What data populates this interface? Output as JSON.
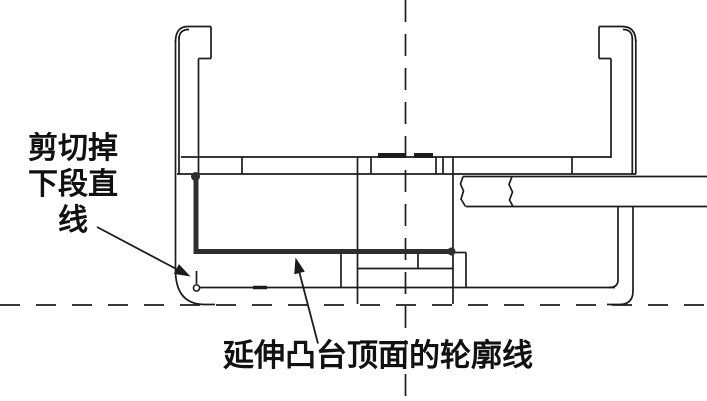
{
  "page": {
    "background": "#ffffff"
  },
  "labels": {
    "left": {
      "lines": [
        "剪切掉",
        "下段直",
        "线"
      ]
    },
    "bottom": {
      "text": "延伸凸台顶面的轮廓线"
    }
  },
  "drawing": {
    "colors": {
      "line": "#1c1c1c",
      "highlight": "#2e2e2e",
      "text": "#111111",
      "background": "#ffffff"
    },
    "stroke": {
      "thin": 1.7,
      "thick": 5,
      "arrow": 1.8
    },
    "segments": [
      [
        175.5,
        40,
        175.5,
        271
      ],
      [
        179,
        37,
        179,
        174
      ],
      [
        188,
        26.5,
        211,
        26.5
      ],
      [
        211,
        26.5,
        211,
        58.5
      ],
      [
        198.5,
        58.5,
        211,
        58.5
      ],
      [
        198.5,
        58.5,
        198.5,
        175
      ],
      [
        599,
        26.5,
        622,
        26.5
      ],
      [
        635.8,
        40,
        635.8,
        174
      ],
      [
        632.3,
        37,
        632.3,
        174
      ],
      [
        599,
        26.5,
        599,
        58.5
      ],
      [
        599,
        58.5,
        611,
        58.5
      ],
      [
        611,
        58.5,
        611,
        158
      ],
      [
        181,
        157,
        611,
        157
      ],
      [
        177,
        174,
        636,
        174
      ],
      [
        242,
        157,
        242,
        174
      ],
      [
        371,
        157,
        371,
        174
      ],
      [
        436,
        157,
        436,
        174
      ],
      [
        443,
        157,
        443,
        174
      ],
      [
        572,
        157,
        572,
        174
      ],
      [
        357.5,
        157,
        357.5,
        304
      ],
      [
        453,
        157,
        453,
        304
      ],
      [
        341,
        253,
        341,
        288
      ],
      [
        357.5,
        268.5,
        453,
        268.5
      ],
      [
        418,
        253,
        418,
        268.5
      ],
      [
        453,
        252.5,
        466,
        252.5
      ],
      [
        466,
        252.5,
        466,
        288
      ],
      [
        197,
        287.5,
        615,
        287.5
      ],
      [
        463,
        176.5,
        707,
        176.5
      ],
      [
        466,
        206.5,
        707,
        206.5
      ],
      [
        196.5,
        271,
        196.5,
        284
      ]
    ],
    "paths": [
      "M175.5,42 Q175.5,26.5 188,26.5",
      "M179,39 Q179,29.5 189,29.5",
      "M622,26.5 Q635.8,26.5 635.8,42",
      "M623,29.5 Q632.3,29.5 632.3,39",
      "M463,176.5 L460.5,184 L463.5,191 L461,199 L465.5,206.5",
      "M512,176.5 L509,184.5 L512.5,192 L509.5,200 L513,206.5",
      "M618,207 L618,280 Q618,287.5 609,287.5",
      "M633,207 L633,291 Q633,304.5 619,304.5 L607,304.5",
      "M175.5,270 Q175.5,304.5 205,304.5 L215,304.5"
    ],
    "accents": [
      {
        "seg": [
          378,
          155.5,
          406,
          155.5
        ],
        "w": 5
      },
      {
        "seg": [
          414,
          155.5,
          433,
          155.5
        ],
        "w": 5
      },
      {
        "seg": [
          253,
          287.5,
          267,
          287.5
        ],
        "w": 3.5
      }
    ],
    "centerlines": [
      {
        "x1": 405.5,
        "y1": 0,
        "x2": 405.5,
        "y2": 401,
        "dash": "22 12"
      },
      {
        "x1": 0,
        "y1": 305,
        "x2": 707,
        "y2": 305,
        "dash": "20 16"
      }
    ],
    "highlight": {
      "path": "M196,177 L196,251.5 L451.5,251.5",
      "width": 5,
      "dots": [
        [
          195.5,
          176.5,
          4.5
        ],
        [
          451.5,
          251.5,
          4
        ]
      ]
    },
    "marker_circle": {
      "cx": 196.5,
      "cy": 288,
      "r": 3.1
    },
    "arrows": [
      {
        "tail": [
          97,
          227
        ],
        "tip": [
          190.5,
          276.5
        ]
      },
      {
        "tail": [
          318,
          343.5
        ],
        "tip": [
          295.5,
          257.5
        ]
      }
    ],
    "arrow_head": {
      "length": 16,
      "half_width": 5.5
    }
  }
}
